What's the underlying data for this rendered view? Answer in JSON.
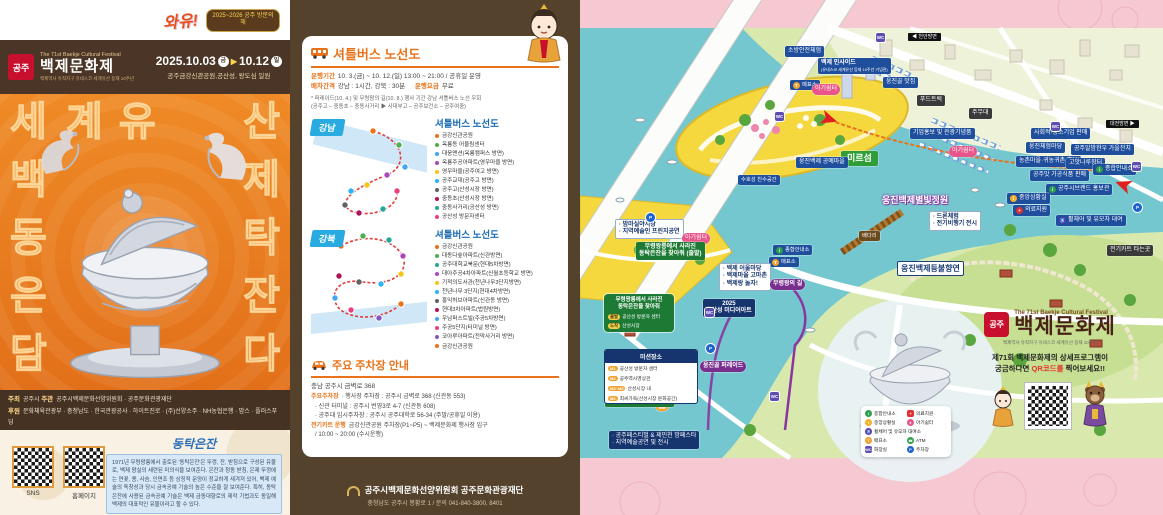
{
  "left": {
    "logos": {
      "wayu": "와유!",
      "visit": "2025~2026 공주 방문의 해"
    },
    "header": {
      "seal": "공주",
      "title_en": "The 71st Baekje Cultural Festival",
      "title_ko": "백제문화제",
      "subtitle": "백제역사 유적지구 유네스코 세계유산 등재 10주년",
      "date_start": "2025.10.03",
      "day_start": "금",
      "arrow": "▶",
      "date_end": "10.12",
      "day_end": "일",
      "venue": "공주금강신관공원,공산성, 왕도심 일원"
    },
    "poster": {
      "left_chars": [
        "세",
        "백",
        "동",
        "은",
        "담"
      ],
      "top_chars": [
        "계",
        "유"
      ],
      "right_chars": [
        "산",
        "제",
        "탁",
        "잔",
        "다"
      ]
    },
    "credits": {
      "host_label": "주최",
      "host": "공주시",
      "organizer_label": "주관",
      "organizers": "공주시백제문화선양위원회 · 공주문화관광재단",
      "sponsor_label": "후원",
      "sponsors": "문화체육관광부 · 충청남도 · 한국관광공사 · 하이트진로 · (주)선양소주 · NH농협은행 · 맘스 · 플러스푸딩"
    },
    "relic": {
      "title": "동탁은잔",
      "description": "1971년 무령왕릉에서 출토된 '동탁은잔'은 뚜껑, 잔, 받침으로 구성된 유물로, 백제 왕실의 세련된 미의식을 보여준다. 은잔과 청동 받침, 은제 뚜껑에는 연꽃, 용, 사슴, 인면조 등 상징적 문양이 정교하게 새겨져 있어, 백제 예술의 독창성과 당시 금속공예 기술의 높은 수준을 잘 보여준다. 특히, 동탁은잔에 사용된 금속공예 기술은 백제 금동대향로의 제작 기법과도 동일해 백제의 대표적인 유물이라고 할 수 있다."
    },
    "qr_codes": [
      {
        "label": "SNS"
      },
      {
        "label": "홈페이지"
      }
    ]
  },
  "middle": {
    "shuttle": {
      "title": "셔틀버스 노선도",
      "period_label": "운행기간",
      "period": "10. 3.(금) ~ 10. 12.(일) 13:00 ~ 21:00 / 공휴일 운영",
      "interval_label": "배차간격",
      "interval": "강남 : 1시간, 강북 : 30분",
      "fare_label": "운행요금",
      "fare": "무료",
      "note_line1": "* 퍼레이드(10. 4.) 및 무령왕의 길(10. 8.) 행사 기간 강남 셔틀버스 노선 우회",
      "note_line2": "(공주고 – 중동초 – 중동사거리 ▶ 사대부고 – 공주보건소 – 공주여중)"
    },
    "gangnam": {
      "badge": "강남",
      "list_title": "셔틀버스 노선도",
      "stops": [
        {
          "name": "금강신관공원",
          "color": "#e8731a"
        },
        {
          "name": "옥룡동 어울림센터",
          "color": "#4caf50"
        },
        {
          "name": "대웅맨션(옥룡캠퍼스 방면)",
          "color": "#42a5f5"
        },
        {
          "name": "옥룡주공아파트(영우마을 방면)",
          "color": "#ab47bc"
        },
        {
          "name": "영우마을(공주여고 방면)",
          "color": "#f5c518"
        },
        {
          "name": "공주교대(공주고 방면)",
          "color": "#29b6f6"
        },
        {
          "name": "공주고(산성시장 방면)",
          "color": "#616161"
        },
        {
          "name": "중동초(산성시장 방면)",
          "color": "#ad1457"
        },
        {
          "name": "중동사거리(공산성 방면)",
          "color": "#26a69a"
        },
        {
          "name": "공산성 방문자센터",
          "color": "#ec407a"
        }
      ]
    },
    "gangbuk": {
      "badge": "강북",
      "list_title": "셔틀버스 노선도",
      "stops": [
        {
          "name": "금강신관공원",
          "color": "#e8731a"
        },
        {
          "name": "대동다숲아파트(신관방면)",
          "color": "#4caf50"
        },
        {
          "name": "공주대학교북문(현대5차방면)",
          "color": "#26a69a"
        },
        {
          "name": "대아주공4차아파트(신월초등학교 방면)",
          "color": "#ab47bc"
        },
        {
          "name": "기적의도서관(천년나무3단지방면)",
          "color": "#f5c518"
        },
        {
          "name": "천년나무 3단지(현대4차방면)",
          "color": "#29b6f6"
        },
        {
          "name": "홍익허브아파트(신관동 방면)",
          "color": "#616161"
        },
        {
          "name": "현대3차아파트(법원방면)",
          "color": "#ad1457"
        },
        {
          "name": "우남퍼스트빌(주공5차방면)",
          "color": "#42a5f5"
        },
        {
          "name": "주공5단지(터미널 방면)",
          "color": "#ec407a"
        },
        {
          "name": "코아루아파트(전막사거리 방면)",
          "color": "#7e57c2"
        },
        {
          "name": "금강신관공원",
          "color": "#e8731a"
        }
      ]
    },
    "parking": {
      "title": "주요 주차장 안내",
      "address": "충남 공주시 금벽로 368",
      "main_label": "주요주차장",
      "rows": [
        "· 행사장 주차장 : 공주시 금벽로 368 (신관동 553)",
        "· 신관 터미널 : 공주시 번영3로 4-7 (신관동 608)",
        "· 공주대 임시주차장 : 공주시 공주대학로 56-34 (주말/공휴일 이용)"
      ],
      "ecart_label": "전기카트 운행",
      "ecart_line1": "금강신관공원 주차장(P1~P5) ~ 백제문화제 행사장 입구",
      "ecart_line2": "/ 10:00 ~ 20:00 (수시운행)"
    },
    "footer": {
      "city": "공주시",
      "orgs": "공주시백제문화선양위원회  공주문화관광재단",
      "address": "충청남도 공주시 봉황로 1 / 문의 041-840-3800, 8401"
    }
  },
  "map": {
    "labels": [
      {
        "type": "navy",
        "x": 205,
        "y": 46,
        "text": "소방안전체험"
      },
      {
        "type": "navy-lg",
        "x": 238,
        "y": 58,
        "text": "백제 인사이드",
        "sub": "(유네스코 세계유산 등재 10주년 기념관)"
      },
      {
        "type": "navy-sm",
        "x": 210,
        "y": 80,
        "text": "매표소",
        "icon": "ticket"
      },
      {
        "type": "pink",
        "x": 232,
        "y": 84,
        "text": "아기쉼터"
      },
      {
        "type": "green-label",
        "x": 261,
        "y": 151,
        "text": "미르섬"
      },
      {
        "type": "navy",
        "x": 216,
        "y": 157,
        "text": "웅진백제 공예마을"
      },
      {
        "type": "navy",
        "x": 303,
        "y": 77,
        "text": "웅진골 맛집"
      },
      {
        "type": "dark",
        "x": 337,
        "y": 95,
        "text": "푸드트럭"
      },
      {
        "type": "dark",
        "x": 389,
        "y": 108,
        "text": "주무대"
      },
      {
        "type": "navy",
        "x": 330,
        "y": 128,
        "text": "기업홍보 및 관광기념품"
      },
      {
        "type": "pink",
        "x": 369,
        "y": 146,
        "text": "아기쉼터"
      },
      {
        "type": "navy",
        "x": 451,
        "y": 128,
        "text": "사회적·중소기업 판매"
      },
      {
        "type": "navy",
        "x": 446,
        "y": 142,
        "text": "웅진체험마당"
      },
      {
        "type": "navy",
        "x": 491,
        "y": 144,
        "text": "공주알밤한우 가을잔치"
      },
      {
        "type": "navy",
        "x": 436,
        "y": 156,
        "text": "농촌마을·귀농귀촌 홍보"
      },
      {
        "type": "navy",
        "x": 486,
        "y": 158,
        "text": "고맛나루장터"
      },
      {
        "type": "navy",
        "x": 513,
        "y": 164,
        "text": "종합안내소",
        "icon": "info"
      },
      {
        "type": "navy",
        "x": 450,
        "y": 170,
        "text": "공주맛 가공식품 판매"
      },
      {
        "type": "navy",
        "x": 466,
        "y": 184,
        "text": "공주시브랜드 홍보관",
        "icon": "info"
      },
      {
        "type": "navy",
        "x": 427,
        "y": 193,
        "text": "중앙상황실",
        "icon": "control"
      },
      {
        "type": "navy",
        "x": 433,
        "y": 205,
        "text": "의료지원",
        "icon": "medical"
      },
      {
        "type": "navy",
        "x": 476,
        "y": 215,
        "text": "휠체어 및 유모차 대여",
        "icon": "wheelchair"
      },
      {
        "type": "dark",
        "x": 527,
        "y": 245,
        "text": "전기카트 타는곳"
      },
      {
        "type": "star-label",
        "x": 299,
        "y": 193,
        "text": "웅진백제별빛정원"
      },
      {
        "type": "white",
        "x": 349,
        "y": 211,
        "lines": [
          "· 드론체험",
          "· 전기비행기 전시"
        ]
      },
      {
        "type": "water-label",
        "x": 317,
        "y": 261,
        "text": "웅진백제등불향연"
      },
      {
        "type": "navy-sm",
        "x": 158,
        "y": 175,
        "text": "수호성 친수공간"
      },
      {
        "type": "white",
        "x": 35,
        "y": 219,
        "lines": [
          "· 밤마실야시장",
          "· 지역예술인 프린지공연"
        ]
      },
      {
        "type": "pink",
        "x": 102,
        "y": 233,
        "text": "아기쉼터"
      },
      {
        "type": "green2",
        "x": 56,
        "y": 242,
        "lines": [
          "무령왕릉에서 사라진",
          "동탁은잔을 찾아줘 (출발)"
        ]
      },
      {
        "type": "navy-sm",
        "x": 193,
        "y": 245,
        "text": "종합안내소",
        "icon": "info"
      },
      {
        "type": "navy-sm",
        "x": 189,
        "y": 257,
        "text": "매표소",
        "icon": "ticket"
      },
      {
        "type": "tagdark",
        "x": 279,
        "y": 231,
        "text": "배다리"
      },
      {
        "type": "white",
        "x": 139,
        "y": 263,
        "lines": [
          "· 백제 어울마당",
          "· 백제마을 고마촌",
          "· 백제랑 놀자!"
        ]
      },
      {
        "type": "purple",
        "x": 190,
        "y": 279,
        "text": "무령왕의 길"
      },
      {
        "type": "dark2",
        "x": 123,
        "y": 299,
        "lines": [
          "2025",
          "공산성 미디어아트"
        ]
      },
      {
        "type": "purple",
        "x": 120,
        "y": 361,
        "text": "웅진골 퍼레이드"
      },
      {
        "type": "orange-pill",
        "x": 93,
        "y": 380,
        "text": "M3~M5"
      },
      {
        "type": "orange-pill",
        "x": 76,
        "y": 404,
        "text": "M6"
      },
      {
        "type": "green2",
        "x": 25,
        "y": 389,
        "lines": [
          "무령왕릉에서 사라진",
          "동탁은잔을 찾아줘 (도착)"
        ]
      },
      {
        "type": "navy2",
        "x": 29,
        "y": 431,
        "lines": [
          "· 공주페스티벌 & 제민천 밤페스타",
          "· 지역예술공연 및 전시"
        ]
      },
      {
        "type": "road",
        "x": 328,
        "y": 33,
        "text": "◀ 천안방면"
      },
      {
        "type": "road",
        "x": 526,
        "y": 120,
        "text": "대전방면 ▶"
      }
    ],
    "icons": [
      {
        "t": "toilet",
        "x": 195,
        "y": 112
      },
      {
        "t": "toilet",
        "x": 296,
        "y": 33
      },
      {
        "t": "toilet",
        "x": 471,
        "y": 122
      },
      {
        "t": "toilet",
        "x": 552,
        "y": 162
      },
      {
        "t": "toilet",
        "x": 125,
        "y": 308
      },
      {
        "t": "toilet",
        "x": 190,
        "y": 392
      },
      {
        "t": "parking",
        "x": 553,
        "y": 203
      },
      {
        "t": "parking",
        "x": 66,
        "y": 213
      },
      {
        "t": "parking",
        "x": 126,
        "y": 344
      }
    ],
    "icon_glyphs": {
      "toilet": "WC",
      "parking": "P"
    },
    "mini_glyphs": {
      "info": "i",
      "ticket": "T",
      "control": "i",
      "medical": "+",
      "wheelchair": "♿"
    },
    "mini_colors": {
      "info": "#2e9e4f",
      "ticket": "#f0a330",
      "control": "#f3b229",
      "medical": "#e03131",
      "wheelchair": "#7a2e8e"
    },
    "quest": {
      "line1": "무령왕릉에서 사라진",
      "line2": "동탁은잔을 찾아줘",
      "start_label": "출발",
      "start": "공산성 방문자 센터",
      "end_label": "도착",
      "end": "산성시장"
    },
    "mission": {
      "title": "미션장소",
      "items": [
        {
          "no": "M1",
          "name": "공산성 방문자 센터"
        },
        {
          "no": "M2",
          "name": "공주역사영상관"
        },
        {
          "no": "M3~M5",
          "name": "산성시장 내"
        },
        {
          "no": "M6",
          "name": "최씨가옥(산성시장 문화공간)"
        }
      ]
    },
    "legend": {
      "items": [
        {
          "icon": "info",
          "color": "#2e9e4f",
          "glyph": "i",
          "text": "종합안내소"
        },
        {
          "icon": "medical",
          "color": "#e03131",
          "glyph": "+",
          "text": "의료지원"
        },
        {
          "icon": "control",
          "color": "#f3b229",
          "glyph": "i",
          "text": "중앙상황실"
        },
        {
          "icon": "baby",
          "color": "#e8558a",
          "glyph": "●",
          "text": "아기쉼터"
        },
        {
          "icon": "wheelchair",
          "color": "#7a2e8e",
          "glyph": "♿",
          "text": "휠체어 및 유모차 대여소",
          "span2": true
        },
        {
          "icon": "ticket",
          "color": "#f0a330",
          "glyph": "T",
          "text": "매표소"
        },
        {
          "icon": "atm",
          "color": "#2e9e4f",
          "glyph": "₩",
          "text": "ATM"
        },
        {
          "icon": "toilet",
          "color": "#5c4db1",
          "glyph": "WC",
          "text": "화장실"
        },
        {
          "icon": "parking",
          "color": "#1c62d1",
          "glyph": "P",
          "text": "주차장"
        }
      ]
    },
    "promo": {
      "seal": "공주",
      "title_en": "The 71st Baekje Cultural Festival",
      "title_ko": "백제문화제",
      "subtitle": "백제역사 유적지구 유네스코 세계유산 등재 10주년",
      "text1": "제71회 백제문화제의 상세프로그램이",
      "text2_pre": "궁금하다면 ",
      "text2_red": "QR코드를",
      "text2_post": " 찍어보세요!!"
    }
  }
}
